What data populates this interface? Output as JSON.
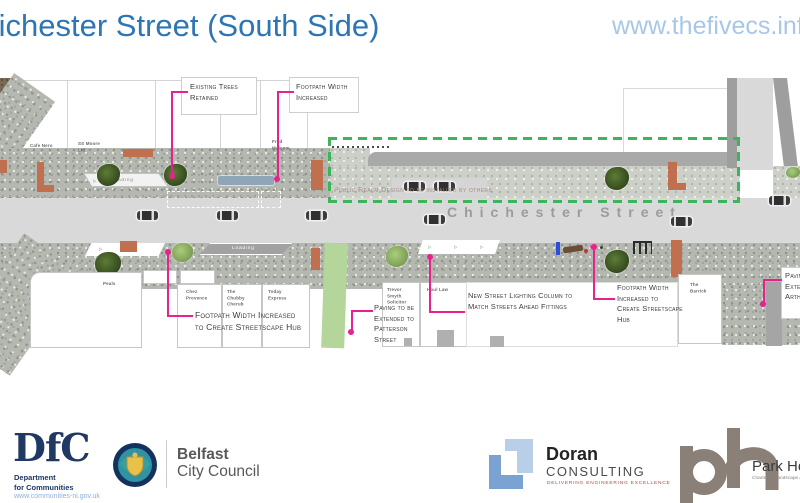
{
  "colors": {
    "title-blue": "#2e75b6",
    "url-blue": "#a8c7e8",
    "pink": "#e82190",
    "green": "#3db457",
    "orange": "#c0704f",
    "road": "#d9d9d9",
    "band": "#a9a9a9",
    "navy": "#1f3864",
    "belfast-gray": "#57585a",
    "doran-red": "#b5413a",
    "taupe": "#8a8077",
    "ann": "#3b3b3b",
    "lbl": "#6a6a6a",
    "street-text": "#9b9b9b",
    "realm-note": "#a58a8a"
  },
  "header": {
    "title": "Chichester Street (South Side)",
    "website": "www.thefivecs.info"
  },
  "plan": {
    "street_name": "Chichester Street",
    "public_realm_note": "Public Realm Design to be installed by others",
    "loading_top": "Loading",
    "loading_bottom": "Loading",
    "buildings": {
      "cafe_nero": "Cafe Nero",
      "ss_moore": "SS Moore\nLtd",
      "fred_malcom": "Fred\nMalcom",
      "peals": "Peals",
      "chez_provence": "Chez\nProvence",
      "chubby_cherub": "The\nChubby\nCherub",
      "today_express": "Today\nExpress",
      "trevor_smyth": "Trevor\nSmyth\nSolicitor",
      "houl_law": "Houl Law",
      "the_barrick": "The\nBarrick"
    },
    "annotations": {
      "existing_trees": "Existing Trees\nRetained",
      "footpath_width_top": "Footpath Width\nIncreased",
      "footpath_hub_left": "Footpath Width Increased\nto Create Streetscape Hub",
      "paving_patterson": "Paving to be\nExtended to\nPatterson\nStreet",
      "new_lighting": "New Street Lighting Column to\nMatch Streets Ahead Fittings",
      "footpath_hub_right": "Footpath Width\nIncreased to\nCreate Streetscape\nHub",
      "paving_arthur": "Paving\nExtend\nArthur"
    }
  },
  "footer": {
    "dfc": {
      "acronym": "DfC",
      "department": "Department\nfor Communities",
      "website": "www.communities-ni.gov.uk"
    },
    "belfast_city_council": {
      "name_line1": "Belfast",
      "name_line2": "City Council"
    },
    "doran": {
      "name": "Doran",
      "type": "CONSULTING",
      "tagline": "DELIVERING ENGINEERING EXCELLENCE"
    },
    "park_hood": {
      "name": "Park Hood",
      "subtitle": "Chartered Landscape Architects"
    }
  }
}
